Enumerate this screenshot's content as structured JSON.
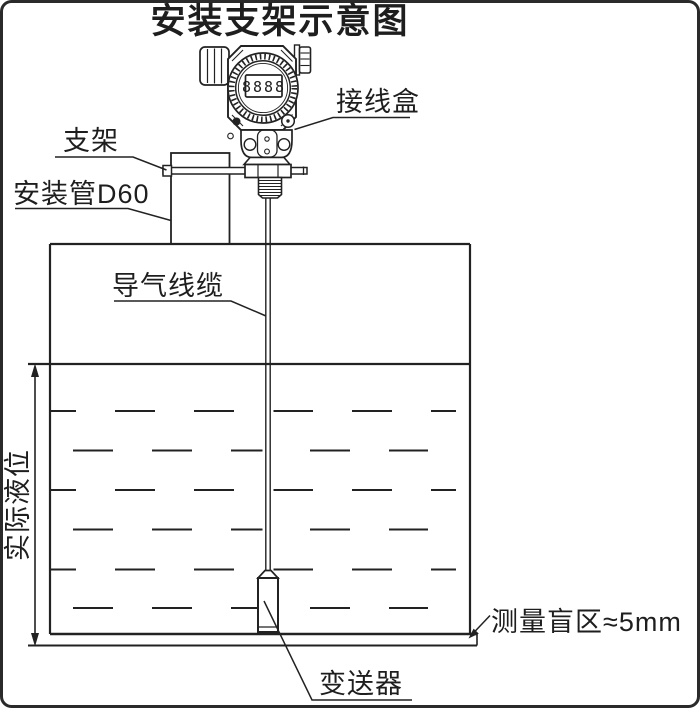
{
  "title": "安装支架示意图",
  "transmitter_head": {
    "display_digits": "8888"
  },
  "labels": {
    "junction_box": "接线盒",
    "bracket": "支架",
    "mounting_pipe": "安装管D60",
    "air_cable": "导气线缆",
    "actual_level": "实际液位",
    "blind_zone": "测量盲区≈5mm",
    "transmitter": "变送器"
  },
  "colors": {
    "background": "#ffffff",
    "line": "#222222",
    "border": "#2a2a2a"
  }
}
